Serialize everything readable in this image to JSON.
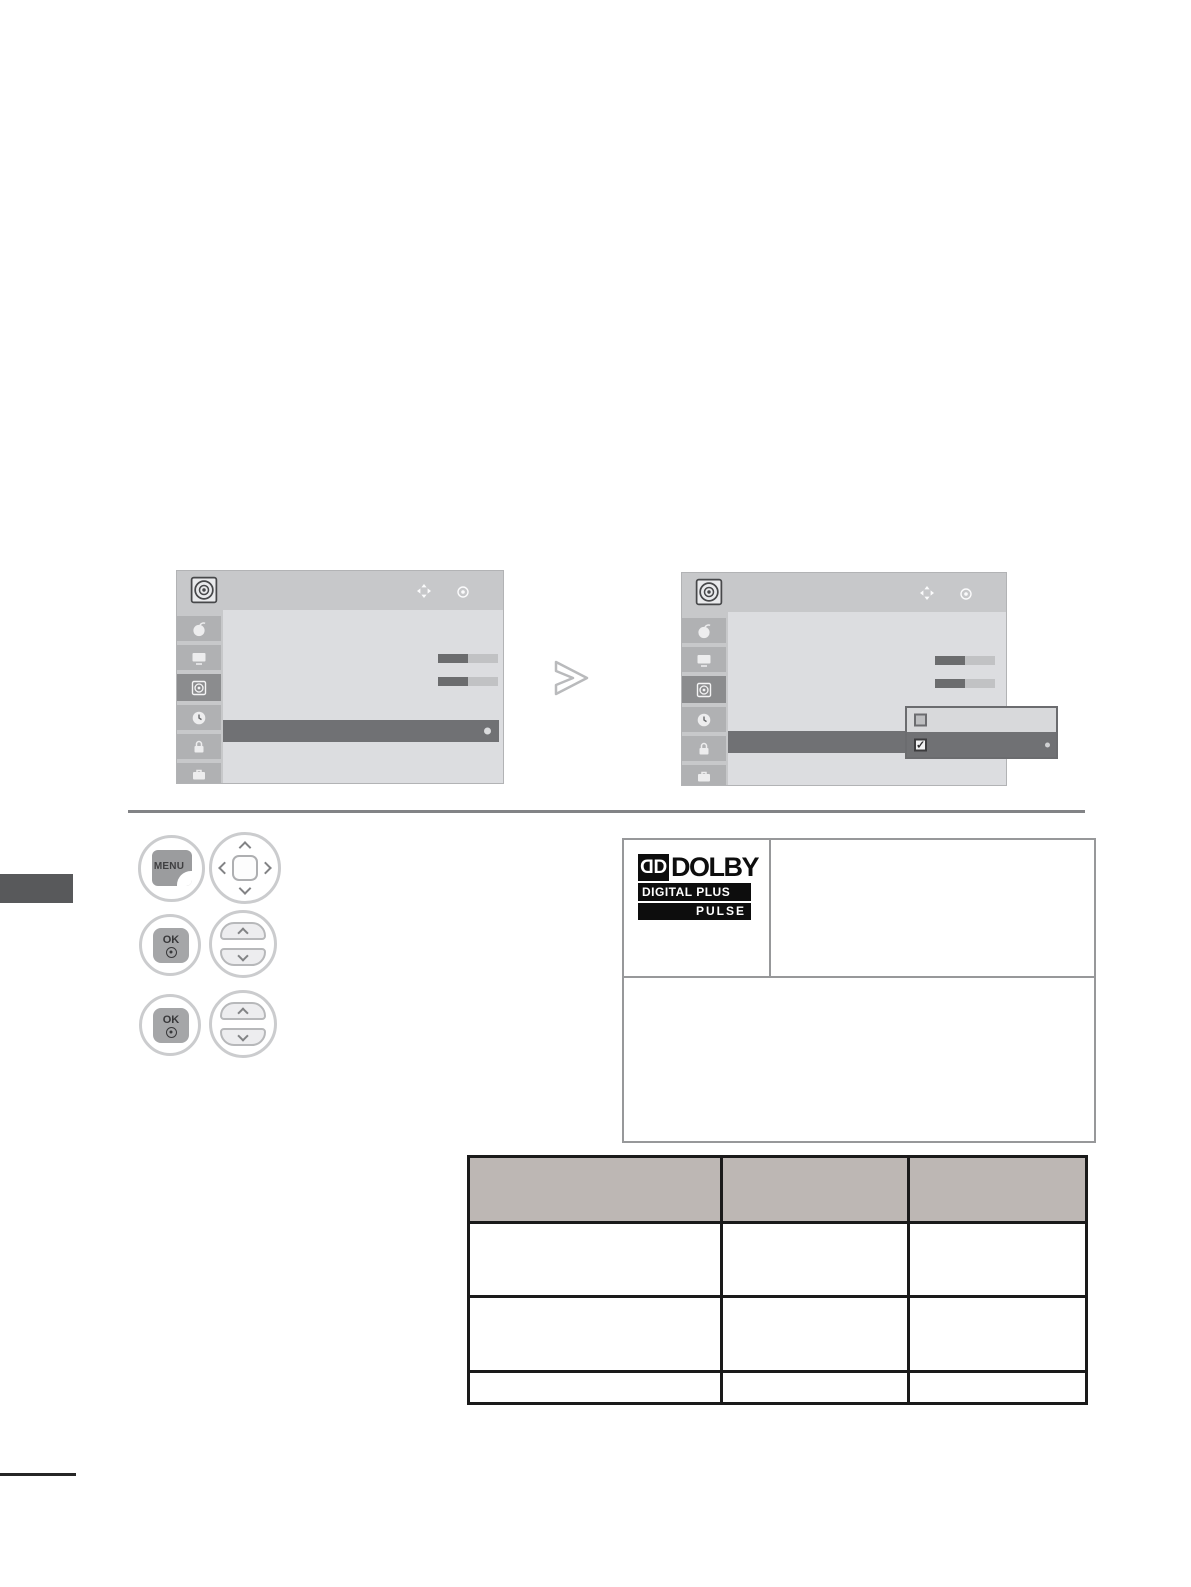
{
  "screens": {
    "header_icon": "speaker-icon",
    "nav_hint_icons": [
      "move-icon",
      "ok-dot-icon"
    ],
    "sidebar_icons": [
      "setup-icon",
      "picture-icon",
      "audio-icon",
      "time-icon",
      "lock-icon",
      "option-icon"
    ],
    "active_sidebar": "audio-icon",
    "sliders": [
      {
        "fill_percent": 50
      },
      {
        "fill_percent": 50
      }
    ],
    "popup": {
      "check_glyph": "✓",
      "options": [
        {
          "checked": false,
          "selected": false
        },
        {
          "checked": true,
          "selected": true
        }
      ]
    }
  },
  "controls": {
    "menu_label": "MENU",
    "ok_label": "OK"
  },
  "dolby_logo": {
    "dd_glyph": "D",
    "brand": "DOLBY",
    "line2": "DIGITAL PLUS",
    "line3": "PULSE"
  },
  "table": {
    "header": [
      "",
      "",
      ""
    ],
    "rows": [
      [
        "",
        "",
        ""
      ],
      [
        "",
        "",
        ""
      ],
      [
        "",
        "",
        ""
      ]
    ],
    "header_bg": "#bdb7b4"
  },
  "colors": {
    "menu_bg": "#c7c8ca",
    "menu_main_bg": "#dcdde0",
    "sidebar_cell": "#b0b1b3",
    "active_cell": "#8b8c8e",
    "highlight_row": "#707174",
    "slider_fill": "#6b6c6e",
    "slider_track": "#c1c2c4",
    "popup_border": "#6b6c6f",
    "side_tab": "#58595b",
    "table_border": "#1a1a1a",
    "dolby_black": "#0d0d0d"
  }
}
